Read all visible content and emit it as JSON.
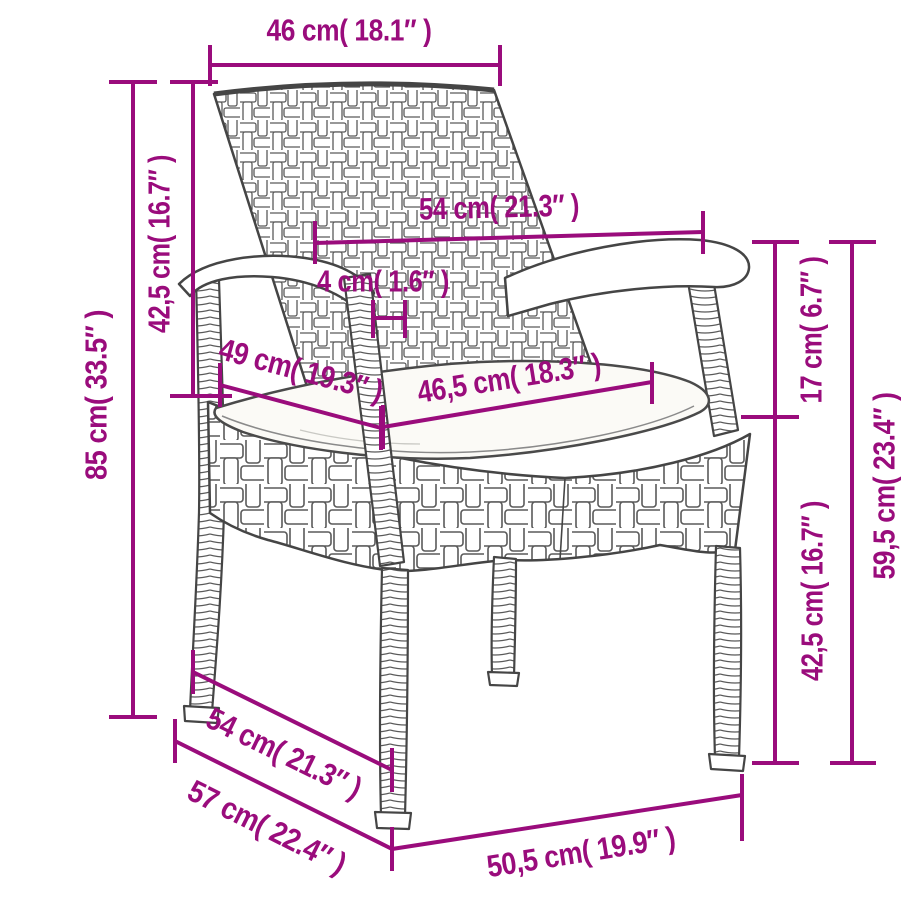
{
  "page": {
    "background": "#ffffff",
    "description": "Dimension diagram of a poly rattan garden armchair with seat cushion"
  },
  "style": {
    "accent_color": "#9a0c7c",
    "drawing_color": "#454545",
    "weave_color": "#5a5a5a",
    "cushion_color": "#fbfaf6"
  },
  "illustration": {
    "subject": "wicker garden armchair with white seat cushion, three-quarter perspective line drawing"
  },
  "dimensions": [
    {
      "name": "backrest-width",
      "label": "46 cm( 18.1″ )",
      "cm": "46",
      "in": "18.1",
      "line": [
        210,
        65,
        500,
        65
      ],
      "ticks": [
        [
          210,
          45,
          210,
          86
        ],
        [
          500,
          45,
          500,
          86
        ]
      ],
      "label_x": 349,
      "label_y": 30,
      "rotation": 0,
      "text_length": 165
    },
    {
      "name": "overall-height",
      "label": "85 cm( 33.5″ )",
      "cm": "85",
      "in": "33.5",
      "line": [
        133,
        82,
        133,
        717
      ],
      "ticks": [
        [
          109,
          82,
          157,
          82
        ],
        [
          109,
          717,
          157,
          717
        ]
      ],
      "label_x": 96,
      "label_y": 395,
      "rotation": -90,
      "text_length": 170
    },
    {
      "name": "backrest-height",
      "label": "42,5 cm( 16.7″ )",
      "cm": "42,5",
      "in": "16.7",
      "line": [
        193,
        82,
        193,
        396
      ],
      "ticks": [
        [
          170,
          82,
          218,
          82
        ],
        [
          170,
          396,
          232,
          396
        ]
      ],
      "label_x": 159,
      "label_y": 244,
      "rotation": -90,
      "text_length": 178
    },
    {
      "name": "armrest-span",
      "label": "54 cm( 21.3″ )",
      "cm": "54",
      "in": "21.3",
      "line": [
        315,
        243,
        703,
        232
      ],
      "ticks": [
        [
          315,
          221,
          315,
          264
        ],
        [
          703,
          211,
          703,
          254
        ]
      ],
      "label_x": 499,
      "label_y": 207,
      "rotation": -1.5,
      "text_length": 160
    },
    {
      "name": "armrest-thickness",
      "label": "4 cm( 1.6″ )",
      "cm": "4",
      "in": "1.6",
      "line": [
        373,
        318,
        405,
        318
      ],
      "ticks": [
        [
          373,
          300,
          373,
          338
        ],
        [
          405,
          300,
          405,
          338
        ]
      ],
      "label_x": 383,
      "label_y": 281,
      "rotation": 0,
      "text_length": 132
    },
    {
      "name": "seat-depth",
      "label": "49 cm( 19.3″ )",
      "cm": "49",
      "in": "19.3",
      "line": [
        220,
        385,
        381,
        428
      ],
      "ticks": [
        [
          220,
          363,
          220,
          407
        ],
        [
          381,
          406,
          381,
          450
        ]
      ],
      "label_x": 301,
      "label_y": 370,
      "rotation": 15,
      "text_length": 168
    },
    {
      "name": "seat-width",
      "label": "46,5 cm( 18.3″ )",
      "cm": "46,5",
      "in": "18.3",
      "line": [
        383,
        427,
        652,
        382
      ],
      "ticks": [
        [
          383,
          405,
          383,
          449
        ],
        [
          652,
          362,
          652,
          404
        ]
      ],
      "label_x": 509,
      "label_y": 378,
      "rotation": -9,
      "text_length": 185
    },
    {
      "name": "armrest-to-seat-gap",
      "label": "17 cm( 6.7″ )",
      "cm": "17",
      "in": "6.7",
      "line": [
        775,
        242,
        775,
        417
      ],
      "ticks": [
        [
          752,
          242,
          799,
          242
        ],
        [
          741,
          417,
          799,
          417
        ]
      ],
      "label_x": 811,
      "label_y": 330,
      "rotation": -90,
      "text_length": 147
    },
    {
      "name": "armrest-height",
      "label": "59,5 cm( 23.4″ )",
      "cm": "59,5",
      "in": "23.4",
      "line": [
        852,
        242,
        852,
        763
      ],
      "ticks": [
        [
          829,
          242,
          876,
          242
        ],
        [
          830,
          763,
          876,
          763
        ]
      ],
      "label_x": 884,
      "label_y": 486,
      "rotation": -90,
      "text_length": 187
    },
    {
      "name": "seat-height",
      "label": "42,5 cm( 16.7″ )",
      "cm": "42,5",
      "in": "16.7",
      "line": [
        775,
        417,
        775,
        763
      ],
      "ticks": [
        [
          752,
          763,
          799,
          763
        ]
      ],
      "label_x": 812,
      "label_y": 591,
      "rotation": -90,
      "text_length": 180
    },
    {
      "name": "base-depth-inner",
      "label": "54 cm( 21.3″ )",
      "cm": "54",
      "in": "21.3",
      "line": [
        193,
        672,
        392,
        770
      ],
      "ticks": [
        [
          193,
          650,
          193,
          694
        ],
        [
          392,
          748,
          392,
          792
        ]
      ],
      "label_x": 284,
      "label_y": 753,
      "rotation": 26,
      "text_length": 168
    },
    {
      "name": "base-depth-outer",
      "label": "57 cm( 22.4″ )",
      "cm": "57",
      "in": "22.4",
      "line": [
        175,
        741,
        392,
        849
      ],
      "ticks": [
        [
          175,
          719,
          175,
          763
        ],
        [
          392,
          827,
          392,
          871
        ]
      ],
      "label_x": 267,
      "label_y": 827,
      "rotation": 26.5,
      "text_length": 172
    },
    {
      "name": "base-width",
      "label": "50,5 cm( 19.9″ )",
      "cm": "50,5",
      "in": "19.9",
      "line": [
        392,
        849,
        742,
        795
      ],
      "ticks": [
        [
          392,
          827,
          392,
          871
        ],
        [
          742,
          774,
          742,
          841
        ]
      ],
      "label_x": 581,
      "label_y": 852,
      "rotation": -9,
      "text_length": 190
    }
  ]
}
